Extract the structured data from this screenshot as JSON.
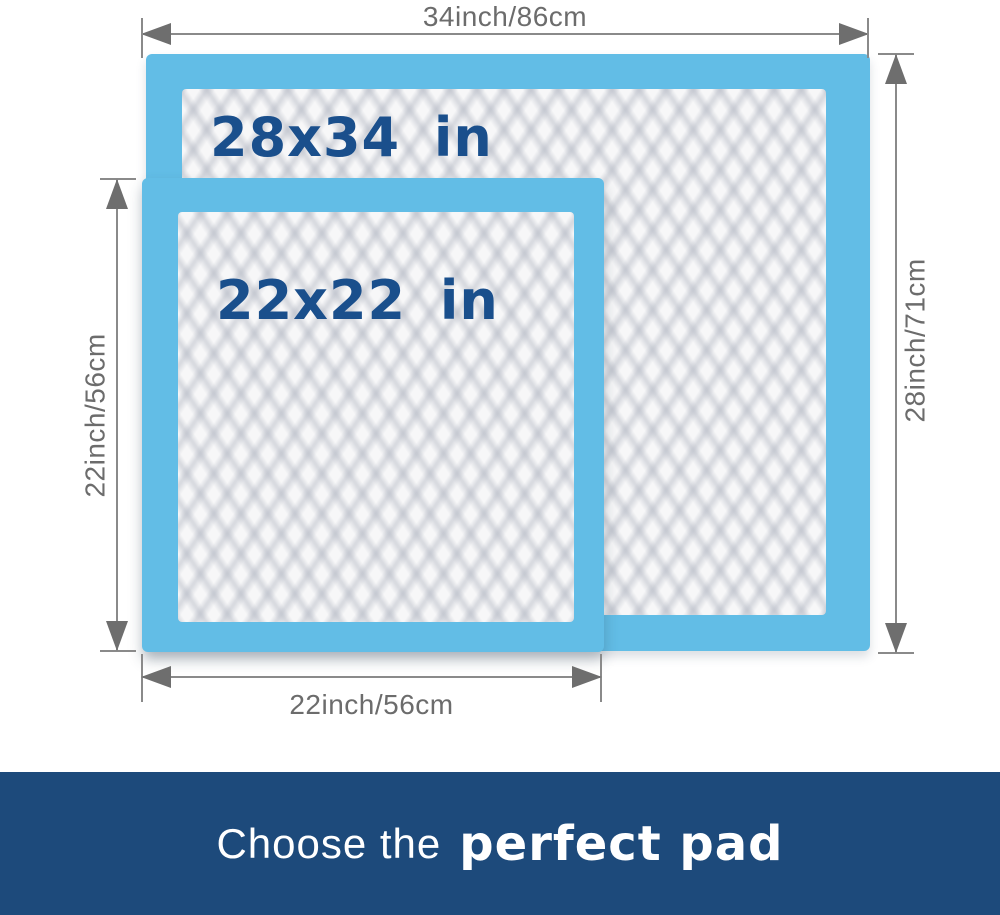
{
  "colors": {
    "pad_blue": "#62bde6",
    "quilt_base": "#f7f7f8",
    "label_navy": "#1a4f8c",
    "dim_text": "#6c6c6c",
    "dim_line": "#8a8a8a",
    "arrow": "#6e6e6e",
    "banner_bg": "#1d4a7b",
    "banner_text": "#ffffff"
  },
  "pads": {
    "large": {
      "label": "28x34 in",
      "width_dim": "34inch/86cm",
      "height_dim": "28inch/71cm"
    },
    "small": {
      "label": "22x22 in",
      "width_dim": "22inch/56cm",
      "height_dim": "22inch/56cm"
    }
  },
  "dimensions": {
    "top": {
      "label": "34inch/86cm"
    },
    "right": {
      "label": "28inch/71cm"
    },
    "left": {
      "label": "22inch/56cm"
    },
    "bottom": {
      "label": "22inch/56cm"
    }
  },
  "banner": {
    "prefix": "Choose the",
    "emphasis": "perfect pad"
  }
}
